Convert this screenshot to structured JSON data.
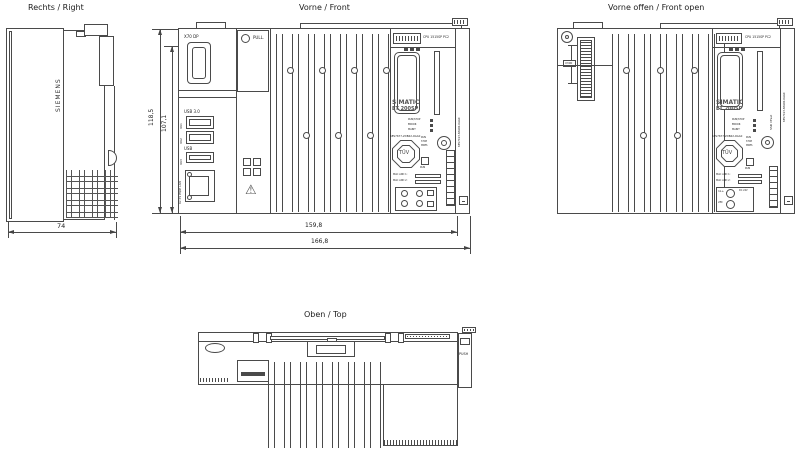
{
  "titles": {
    "right": "Rechts / Right",
    "front": "Vorne / Front",
    "front_open": "Vorne offen / Front open",
    "top": "Oben / Top"
  },
  "dimensions": {
    "depth": "74",
    "height_total": "118,5",
    "height_body": "107,1",
    "width_body": "159,8",
    "width_total": "166,8"
  },
  "right_view": {
    "brand": "SIEMENS"
  },
  "front_view": {
    "display_port_label": "X70 DP",
    "pull_label": "PULL.",
    "usb_group_label": "USB 3.0",
    "usb_port_ids": [
      "X61",
      "X62",
      "X63"
    ],
    "usb_single_label": "USB",
    "lan_label": "X2 P1 PN/IE LAN",
    "product_label": "CPU 1515SP PC2",
    "brand_line1": "SIMATIC",
    "brand_line2": "ET 200SP",
    "article_number": "6ES7677-2DB42-0GA0",
    "led_labels": [
      "RUN/STOP",
      "ERROR",
      "MAINT"
    ],
    "selector_labels": [
      "RUN",
      "STOP",
      "MRES"
    ],
    "run_label": "RUN",
    "tuv_label": "TÜV",
    "mac_labels": [
      "MAC ADD 1:",
      "MAC ADD 2:"
    ],
    "server_module_article": "6ES7193-6PA00-0AA0"
  },
  "front_open_view": {
    "connector_label": "X300",
    "storage_label": "SSD  CFast",
    "power_labels": [
      "1L+",
      "2M"
    ],
    "supply_label": "DC 24V"
  },
  "top_view": {
    "push_label": "PUSH"
  }
}
